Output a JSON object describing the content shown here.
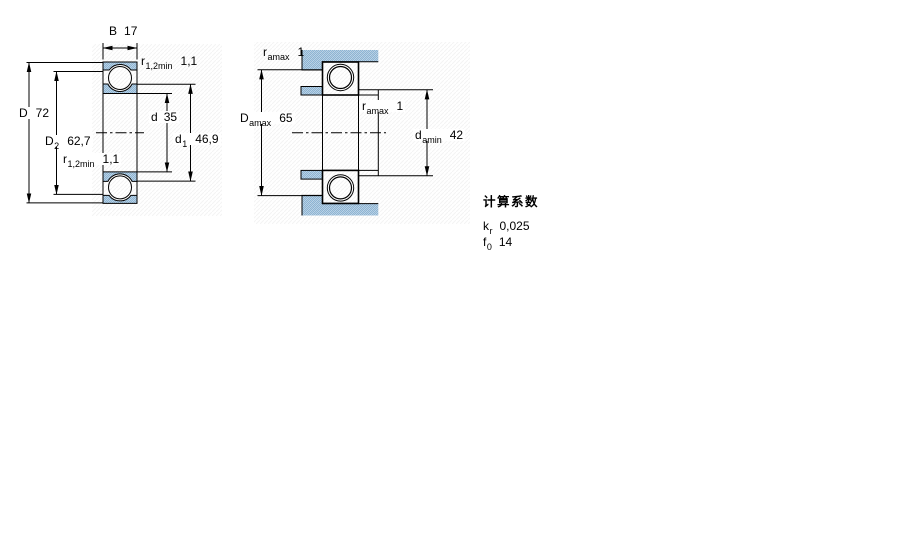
{
  "left_diagram": {
    "B": {
      "sym": "B",
      "value": "17"
    },
    "r_top": {
      "sym": "r",
      "sub": "1,2min",
      "value": "1,1"
    },
    "D": {
      "sym": "D",
      "value": "72"
    },
    "D2": {
      "sym": "D",
      "sub": "2",
      "value": "62,7"
    },
    "r_bottom": {
      "sym": "r",
      "sub": "1,2min",
      "value": "1,1"
    },
    "d": {
      "sym": "d",
      "value": "35"
    },
    "d1": {
      "sym": "d",
      "sub": "1",
      "value": "46,9"
    }
  },
  "right_diagram": {
    "r_a_top": {
      "sym": "r",
      "sub": "amax",
      "value": "1"
    },
    "D_a": {
      "sym": "D",
      "sub": "amax",
      "value": "65"
    },
    "r_a_mid": {
      "sym": "r",
      "sub": "amax",
      "value": "1"
    },
    "d_a": {
      "sym": "d",
      "sub": "amin",
      "value": "42"
    }
  },
  "factors": {
    "title": "计算系数",
    "k": {
      "sym": "k",
      "sub": "r",
      "value": "0,025"
    },
    "f": {
      "sym": "f",
      "sub": "0",
      "value": "14"
    }
  },
  "colors": {
    "line": "#000000",
    "section_fill_light": "#bdd4e7",
    "section_fill_dark": "#8eb6d6",
    "background": "#ffffff"
  }
}
